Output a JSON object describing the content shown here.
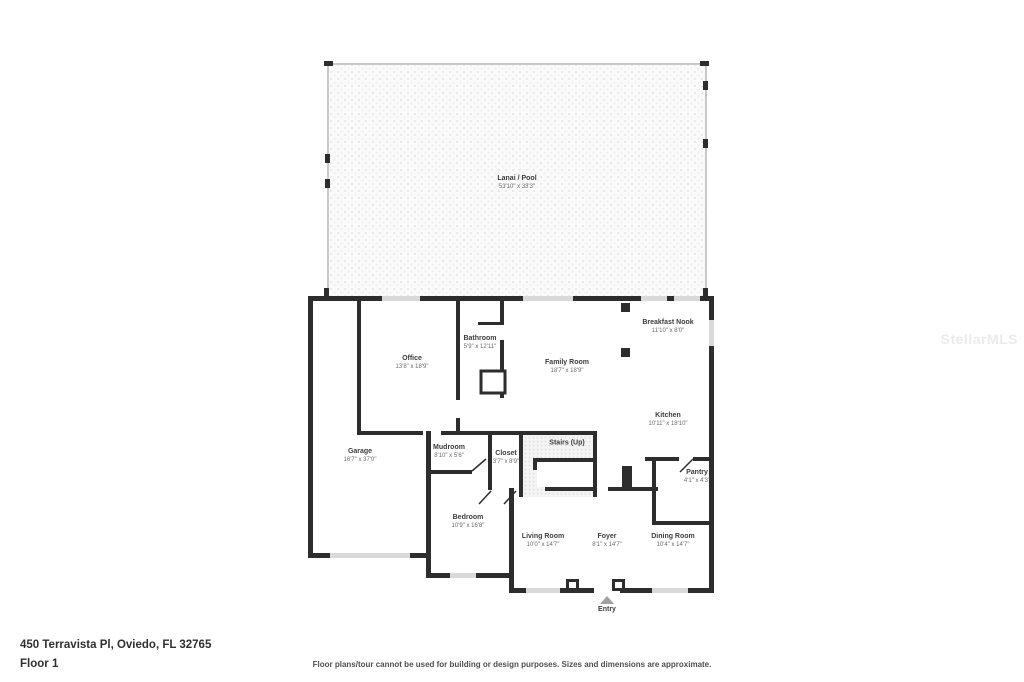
{
  "watermark": "StellarMLS",
  "floor_plan": {
    "rooms": [
      {
        "name": "Lanai / Pool",
        "dims": "53'10\" x 33'3\""
      },
      {
        "name": "Office",
        "dims": "13'8\" x 18'9\""
      },
      {
        "name": "Bathroom",
        "dims": "5'9\" x 12'11\""
      },
      {
        "name": "Family Room",
        "dims": "18'7\" x 18'9\""
      },
      {
        "name": "Breakfast Nook",
        "dims": "11'10\" x 8'0\""
      },
      {
        "name": "Kitchen",
        "dims": "10'11\" x 18'10\""
      },
      {
        "name": "Garage",
        "dims": "16'7\" x 37'0\""
      },
      {
        "name": "Mudroom",
        "dims": "8'10\" x 5'6\""
      },
      {
        "name": "Closet",
        "dims": "3'7\" x 8'9\""
      },
      {
        "name": "Stairs (Up)",
        "dims": ""
      },
      {
        "name": "Pantry",
        "dims": "4'1\" x 4'3\""
      },
      {
        "name": "Bedroom",
        "dims": "10'9\" x 16'8\""
      },
      {
        "name": "Living Room",
        "dims": "10'0\" x 14'7\""
      },
      {
        "name": "Foyer",
        "dims": "8'1\" x 14'7\""
      },
      {
        "name": "Dining Room",
        "dims": "10'4\" x 14'7\""
      }
    ],
    "entry_label": "Entry"
  },
  "footer": {
    "address": "450 Terravista Pl, Oviedo, FL 32765",
    "floor_label": "Floor 1",
    "disclaimer": "Floor plans/tour cannot be used for building or design purposes. Sizes and dimensions are approximate."
  },
  "colors": {
    "wall": "#2d2d2d",
    "window": "#d9d9d9",
    "lanai_border": "#c9c9c9",
    "watermark": "#ebebeb"
  }
}
